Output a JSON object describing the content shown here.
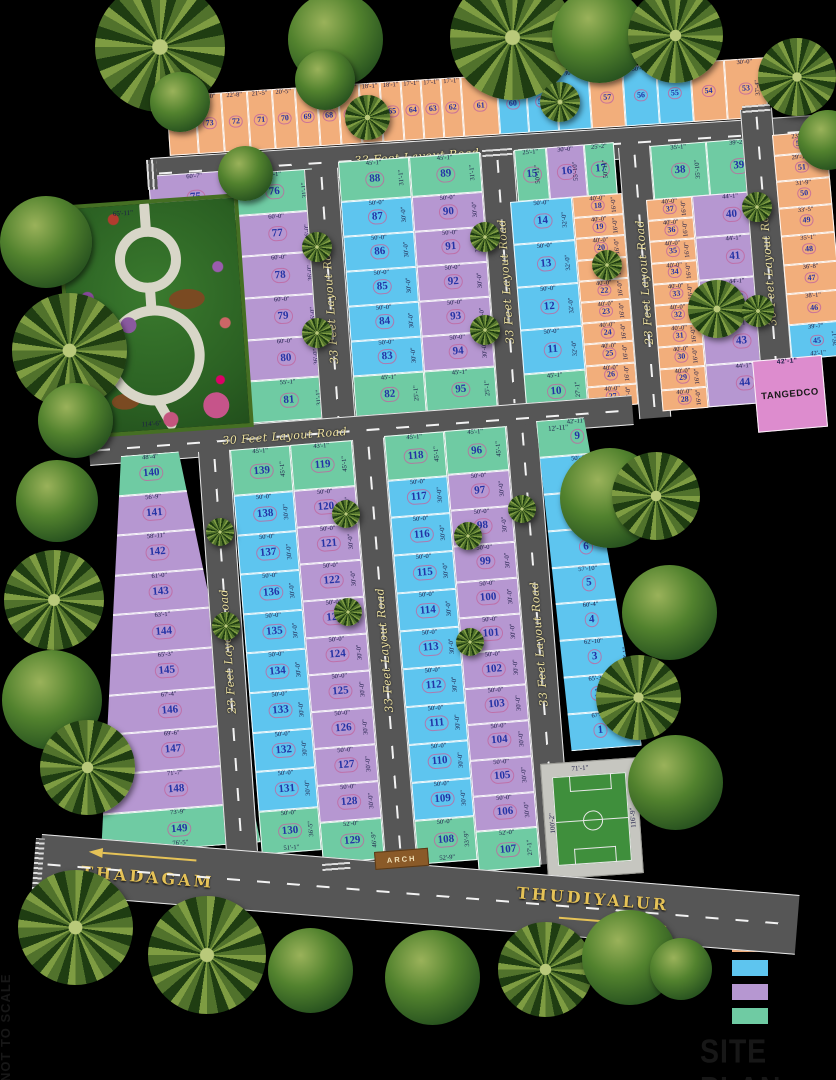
{
  "title": "SITE PLAN",
  "scale_note": "NOT TO SCALE",
  "legend": [
    {
      "name": "orange",
      "hex": "#F2AE7B",
      "label": ""
    },
    {
      "name": "blue",
      "hex": "#5EC5EF",
      "label": ""
    },
    {
      "name": "purple",
      "hex": "#B697D1",
      "label": ""
    },
    {
      "name": "green",
      "hex": "#6FCBA3",
      "label": ""
    }
  ],
  "roads": {
    "top": "33 Feet Layout Road",
    "v_park": "33 Feet Layout Road",
    "v_a": "33 Feet Layout Road",
    "v_23": "23 Feet Layout Road",
    "v_30": "30 Feet Layout Road",
    "mid": "30 Feet Layout Road",
    "v_23b": "23 Feet Layout Road",
    "v_33b": "33 Feet Layout Road",
    "v_33c": "33 Feet Layout Road",
    "thadagam": "THADAGAM",
    "thudiyalur": "THUDIYALUR"
  },
  "labels": {
    "tangedco": "TANGEDCO",
    "tangedco_top": "42'-1\"",
    "arch": "ARCH",
    "park_bottom": "114'-6\"",
    "park_top": "65'-11\"",
    "near9": "12'-11\""
  },
  "field": {
    "top": "71'-1\"",
    "left": "100'-2\"",
    "right": "116'-9\"",
    "bottom": "68'-0\"",
    "corner": "16'-3\""
  },
  "top_strip": [
    {
      "n": "74",
      "c": "o",
      "d": "24'-8\""
    },
    {
      "n": "73",
      "c": "o",
      "d": "23'-0\""
    },
    {
      "n": "72",
      "c": "o",
      "d": "22'-8\""
    },
    {
      "n": "71",
      "c": "o",
      "d": "21'-5\""
    },
    {
      "n": "70",
      "c": "o",
      "d": "20'-5\""
    },
    {
      "n": "69",
      "c": "o",
      "d": "19'-1\""
    },
    {
      "n": "68",
      "c": "o",
      "d": "18'-1\""
    },
    {
      "n": "67",
      "c": "o",
      "d": "18'-1\""
    },
    {
      "n": "66",
      "c": "o",
      "d": "18'-1\""
    },
    {
      "n": "65",
      "c": "o",
      "d": "18'-1\""
    },
    {
      "n": "64",
      "c": "o",
      "d": "17'-1\""
    },
    {
      "n": "63",
      "c": "o",
      "d": "17'-1\""
    },
    {
      "n": "62",
      "c": "o",
      "d": "17'-1\""
    },
    {
      "n": "61",
      "c": "o",
      "d": "32'-0\""
    },
    {
      "n": "60",
      "c": "b",
      "d": "16'-6\""
    },
    {
      "n": "59",
      "c": "b",
      "d": "25'-11\""
    },
    {
      "n": "58",
      "c": "b",
      "d": "30'-0\""
    },
    {
      "n": "57",
      "c": "o",
      "d": "30'-0\""
    },
    {
      "n": "56",
      "c": "b",
      "d": "30'-0\""
    },
    {
      "n": "55",
      "c": "b",
      "d": "30'-0\""
    },
    {
      "n": "54",
      "c": "o",
      "d": "30'-0\""
    },
    {
      "n": "53",
      "c": "o",
      "d": "30'-0\"",
      "s": "37'-4\""
    }
  ],
  "col75": [
    {
      "n": "75",
      "c": "p",
      "d": "60'-7\"",
      "s": "36'-2\""
    }
  ],
  "col76": [
    {
      "n": "76",
      "c": "g",
      "d": "55'-1\"",
      "s": "31'-1\""
    },
    {
      "n": "77",
      "c": "p",
      "d": "60'-0\"",
      "s": "36'-0\""
    },
    {
      "n": "78",
      "c": "p",
      "d": "60'-0\"",
      "s": "36'-0\""
    },
    {
      "n": "79",
      "c": "p",
      "d": "60'-0\"",
      "s": "36'-0\""
    },
    {
      "n": "80",
      "c": "p",
      "d": "60'-0\"",
      "s": "36'-0\""
    },
    {
      "n": "81",
      "c": "g",
      "d": "55'-1\"",
      "s": "31'-1\""
    }
  ],
  "blockA_left": [
    {
      "n": "88",
      "c": "g",
      "d": "45'-1\"",
      "s": "31'-1\""
    },
    {
      "n": "87",
      "c": "b",
      "d": "50'-0\"",
      "s": "30'-0\""
    },
    {
      "n": "86",
      "c": "b",
      "d": "50'-0\"",
      "s": "30'-0\""
    },
    {
      "n": "85",
      "c": "b",
      "d": "50'-0\"",
      "s": "30'-0\""
    },
    {
      "n": "84",
      "c": "b",
      "d": "50'-0\"",
      "s": "30'-0\""
    },
    {
      "n": "83",
      "c": "b",
      "d": "50'-0\"",
      "s": "30'-0\""
    },
    {
      "n": "82",
      "c": "g",
      "d": "45'-1\"",
      "s": "25'-1\""
    }
  ],
  "blockA_right": [
    {
      "n": "89",
      "c": "g",
      "d": "45'-1\"",
      "s": "31'-1\""
    },
    {
      "n": "90",
      "c": "p",
      "d": "50'-0\"",
      "s": "30'-0\""
    },
    {
      "n": "91",
      "c": "p",
      "d": "50'-0\"",
      "s": "30'-0\""
    },
    {
      "n": "92",
      "c": "p",
      "d": "50'-0\"",
      "s": "30'-0\""
    },
    {
      "n": "93",
      "c": "p",
      "d": "50'-0\"",
      "s": "30'-0\""
    },
    {
      "n": "94",
      "c": "p",
      "d": "50'-0\"",
      "s": "30'-0\""
    },
    {
      "n": "95",
      "c": "g",
      "d": "45'-1\"",
      "s": "25'-1\""
    }
  ],
  "blockB_top": [
    {
      "n": "15",
      "c": "g",
      "d": "25'-1\"",
      "s": "50'-11\""
    },
    {
      "n": "16",
      "c": "p",
      "d": "30'-0\"",
      "s": "55'-10\""
    },
    {
      "n": "17",
      "c": "g",
      "d": "25'-2\"",
      "s": "50'-11\""
    }
  ],
  "blockB_col": [
    {
      "n": "14",
      "c": "b",
      "d": "50'-0\"",
      "s": "32'-0\""
    },
    {
      "n": "13",
      "c": "b",
      "d": "50'-0\"",
      "s": "32'-0\""
    },
    {
      "n": "12",
      "c": "b",
      "d": "50'-0\"",
      "s": "32'-0\""
    },
    {
      "n": "11",
      "c": "b",
      "d": "50'-0\"",
      "s": "32'-0\""
    },
    {
      "n": "10",
      "c": "g",
      "d": "45'-1\"",
      "s": "27'-1\""
    }
  ],
  "strip18": [
    {
      "n": "18",
      "c": "o",
      "d": "40'-0\"",
      "s": "16'-0\""
    },
    {
      "n": "19",
      "c": "o",
      "d": "40'-0\"",
      "s": "16'-0\""
    },
    {
      "n": "20",
      "c": "o",
      "d": "40'-0\"",
      "s": "16'-0\""
    },
    {
      "n": "21",
      "c": "o",
      "d": "40'-0\"",
      "s": "16'-0\""
    },
    {
      "n": "22",
      "c": "o",
      "d": "40'-0\"",
      "s": "16'-0\""
    },
    {
      "n": "23",
      "c": "o",
      "d": "40'-0\"",
      "s": "16'-0\""
    },
    {
      "n": "24",
      "c": "o",
      "d": "40'-0\"",
      "s": "16'-0\""
    },
    {
      "n": "25",
      "c": "o",
      "d": "40'-0\"",
      "s": "16'-0\""
    },
    {
      "n": "26",
      "c": "o",
      "d": "40'-0\"",
      "s": "16'-0\""
    },
    {
      "n": "27",
      "c": "o",
      "d": "40'-0\"",
      "s": "16'-0\""
    }
  ],
  "blockC_top": [
    {
      "n": "38",
      "c": "g",
      "d": "35'-1\"",
      "s": "35'-10\""
    },
    {
      "n": "39",
      "c": "g",
      "d": "39'-2\"",
      "s": "50'-11\""
    }
  ],
  "blockC_left": [
    {
      "n": "37",
      "c": "o",
      "d": "40'-0\"",
      "s": "16'-0\""
    },
    {
      "n": "36",
      "c": "o",
      "d": "40'-0\"",
      "s": "16'-0\""
    },
    {
      "n": "35",
      "c": "o",
      "d": "40'-0\"",
      "s": "16'-0\""
    },
    {
      "n": "34",
      "c": "o",
      "d": "40'-0\"",
      "s": "16'-0\""
    },
    {
      "n": "33",
      "c": "o",
      "d": "40'-0\"",
      "s": "16'-0\""
    },
    {
      "n": "32",
      "c": "o",
      "d": "40'-0\"",
      "s": "16'-0\""
    },
    {
      "n": "31",
      "c": "o",
      "d": "40'-0\"",
      "s": "16'-0\""
    },
    {
      "n": "30",
      "c": "o",
      "d": "40'-0\"",
      "s": "16'-0\""
    },
    {
      "n": "29",
      "c": "o",
      "d": "40'-0\"",
      "s": "16'-0\""
    },
    {
      "n": "28",
      "c": "o",
      "d": "40'-0\"",
      "s": "16'-0\""
    }
  ],
  "blockC_right": [
    {
      "n": "40",
      "c": "p",
      "d": "44'-1\"",
      "s": "32'-0\""
    },
    {
      "n": "41",
      "c": "p",
      "d": "44'-1\"",
      "s": "32'-0\""
    },
    {
      "n": "42",
      "c": "p",
      "d": "44'-1\"",
      "s": "32'-0\""
    },
    {
      "n": "43",
      "c": "p",
      "d": "44'-1\"",
      "s": "32'-0\""
    },
    {
      "n": "44",
      "c": "p",
      "d": "44'-1\"",
      "s": "31'-2\""
    }
  ],
  "col_right": [
    {
      "n": "52",
      "c": "o",
      "d": "23'-1\""
    },
    {
      "n": "51",
      "c": "o",
      "d": "29'-11\""
    },
    {
      "n": "50",
      "c": "o",
      "d": "31'-9\""
    },
    {
      "n": "49",
      "c": "o",
      "d": "33'-5\""
    },
    {
      "n": "48",
      "c": "o",
      "d": "35'-1\""
    },
    {
      "n": "47",
      "c": "o",
      "d": "36'-8\""
    },
    {
      "n": "46",
      "c": "o",
      "d": "38'-1\""
    },
    {
      "n": "45",
      "c": "b",
      "d": "39'-7\"",
      "b": "42'-1\"",
      "s": "26'-1\""
    }
  ],
  "col140": [
    {
      "n": "140",
      "c": "g",
      "d": "48'-4\"",
      "s": "45'-1\""
    },
    {
      "n": "141",
      "c": "p",
      "d": "56'-9\"",
      "s": "30'-1\""
    },
    {
      "n": "142",
      "c": "p",
      "d": "58'-11\"",
      "s": "30'-1\""
    },
    {
      "n": "143",
      "c": "p",
      "d": "61'-0\"",
      "s": "30'-1\""
    },
    {
      "n": "144",
      "c": "p",
      "d": "63'-1\"",
      "s": "30'-1\""
    },
    {
      "n": "145",
      "c": "p",
      "d": "65'-3\"",
      "s": "30'-1\""
    },
    {
      "n": "146",
      "c": "p",
      "d": "67'-4\"",
      "s": "30'-1\""
    },
    {
      "n": "147",
      "c": "p",
      "d": "69'-6\"",
      "s": "30'-1\""
    },
    {
      "n": "148",
      "c": "p",
      "d": "71'-7\"",
      "s": "30'-1\""
    },
    {
      "n": "149",
      "c": "g",
      "d": "73'-9\"",
      "b": "76'-5\"",
      "s": "17'-0\""
    }
  ],
  "blockD_left": [
    {
      "n": "139",
      "c": "g",
      "d": "45'-1\"",
      "s": "45'-1\""
    },
    {
      "n": "138",
      "c": "b",
      "d": "50'-0\"",
      "s": "30'-0\""
    },
    {
      "n": "137",
      "c": "b",
      "d": "50'-0\"",
      "s": "30'-0\""
    },
    {
      "n": "136",
      "c": "b",
      "d": "50'-0\"",
      "s": "30'-0\""
    },
    {
      "n": "135",
      "c": "b",
      "d": "50'-0\"",
      "s": "30'-0\""
    },
    {
      "n": "134",
      "c": "b",
      "d": "50'-0\"",
      "s": "30'-0\""
    },
    {
      "n": "133",
      "c": "b",
      "d": "50'-0\"",
      "s": "30'-0\""
    },
    {
      "n": "132",
      "c": "b",
      "d": "50'-0\"",
      "s": "30'-0\""
    },
    {
      "n": "131",
      "c": "b",
      "d": "50'-0\"",
      "s": "30'-0\""
    },
    {
      "n": "130",
      "c": "g",
      "d": "50'-0\"",
      "b": "51'-1\"",
      "s": "36'-5\""
    }
  ],
  "blockD_right": [
    {
      "n": "119",
      "c": "g",
      "d": "43'-1\"",
      "s": "45'-1\""
    },
    {
      "n": "120",
      "c": "p",
      "d": "50'-0\"",
      "s": "30'-0\""
    },
    {
      "n": "121",
      "c": "p",
      "d": "50'-0\"",
      "s": "30'-0\""
    },
    {
      "n": "122",
      "c": "p",
      "d": "50'-0\"",
      "s": "30'-0\""
    },
    {
      "n": "123",
      "c": "p",
      "d": "50'-0\"",
      "s": "30'-0\""
    },
    {
      "n": "124",
      "c": "p",
      "d": "50'-0\"",
      "s": "30'-0\""
    },
    {
      "n": "125",
      "c": "p",
      "d": "50'-0\"",
      "s": "30'-0\""
    },
    {
      "n": "126",
      "c": "p",
      "d": "50'-0\"",
      "s": "30'-0\""
    },
    {
      "n": "127",
      "c": "p",
      "d": "50'-0\"",
      "s": "30'-0\""
    },
    {
      "n": "128",
      "c": "p",
      "d": "50'-0\"",
      "s": "30'-0\""
    },
    {
      "n": "129",
      "c": "g",
      "d": "52'-0\"",
      "s": "46'-9\""
    }
  ],
  "blockE_left": [
    {
      "n": "118",
      "c": "g",
      "d": "45'-1\"",
      "s": "45'-1\""
    },
    {
      "n": "117",
      "c": "b",
      "d": "50'-0\"",
      "s": "30'-0\""
    },
    {
      "n": "116",
      "c": "b",
      "d": "50'-0\"",
      "s": "30'-0\""
    },
    {
      "n": "115",
      "c": "b",
      "d": "50'-0\"",
      "s": "30'-0\""
    },
    {
      "n": "114",
      "c": "b",
      "d": "50'-0\"",
      "s": "30'-0\""
    },
    {
      "n": "113",
      "c": "b",
      "d": "50'-0\"",
      "s": "30'-0\""
    },
    {
      "n": "112",
      "c": "b",
      "d": "50'-0\"",
      "s": "30'-0\""
    },
    {
      "n": "111",
      "c": "b",
      "d": "50'-0\"",
      "s": "30'-0\""
    },
    {
      "n": "110",
      "c": "b",
      "d": "50'-0\"",
      "s": "30'-0\""
    },
    {
      "n": "109",
      "c": "b",
      "d": "50'-0\"",
      "s": "30'-0\""
    },
    {
      "n": "108",
      "c": "g",
      "d": "50'-0\"",
      "b": "52'-9\"",
      "s": "33'-9\""
    }
  ],
  "blockE_right": [
    {
      "n": "96",
      "c": "g",
      "d": "45'-1\"",
      "s": "45'-1\""
    },
    {
      "n": "97",
      "c": "p",
      "d": "50'-0\"",
      "s": "30'-0\""
    },
    {
      "n": "98",
      "c": "p",
      "d": "50'-0\"",
      "s": "30'-0\""
    },
    {
      "n": "99",
      "c": "p",
      "d": "50'-0\"",
      "s": "30'-0\""
    },
    {
      "n": "100",
      "c": "p",
      "d": "50'-0\"",
      "s": "30'-0\""
    },
    {
      "n": "101",
      "c": "p",
      "d": "50'-0\"",
      "s": "30'-0\""
    },
    {
      "n": "102",
      "c": "p",
      "d": "50'-0\"",
      "s": "30'-0\""
    },
    {
      "n": "103",
      "c": "p",
      "d": "50'-0\"",
      "s": "30'-0\""
    },
    {
      "n": "104",
      "c": "p",
      "d": "50'-0\"",
      "s": "30'-0\""
    },
    {
      "n": "105",
      "c": "p",
      "d": "50'-0\"",
      "s": "30'-0\""
    },
    {
      "n": "106",
      "c": "p",
      "d": "50'-0\"",
      "s": "30'-0\""
    },
    {
      "n": "107",
      "c": "g",
      "d": "52'-0\"",
      "s": "27'-1\""
    }
  ],
  "col1_9": [
    {
      "n": "9",
      "c": "g",
      "d": "42'-11\"",
      "s": "30'-1\""
    },
    {
      "n": "8",
      "c": "b",
      "d": "50'-4\"",
      "s": "30'-1\""
    },
    {
      "n": "7",
      "c": "b",
      "d": "52'-10\"",
      "s": "30'-1\""
    },
    {
      "n": "6",
      "c": "b",
      "d": "55'-4\"",
      "s": "30'-1\""
    },
    {
      "n": "5",
      "c": "b",
      "d": "57'-10\"",
      "s": "30'-1\""
    },
    {
      "n": "4",
      "c": "b",
      "d": "60'-4\"",
      "s": "30'-1\""
    },
    {
      "n": "3",
      "c": "b",
      "d": "62'-10\"",
      "s": "30'-1\""
    },
    {
      "n": "2",
      "c": "b",
      "d": "65'-3\"",
      "s": "30'-1\""
    },
    {
      "n": "1",
      "c": "b",
      "d": "67'-9\"",
      "s": "40'-0\""
    }
  ]
}
